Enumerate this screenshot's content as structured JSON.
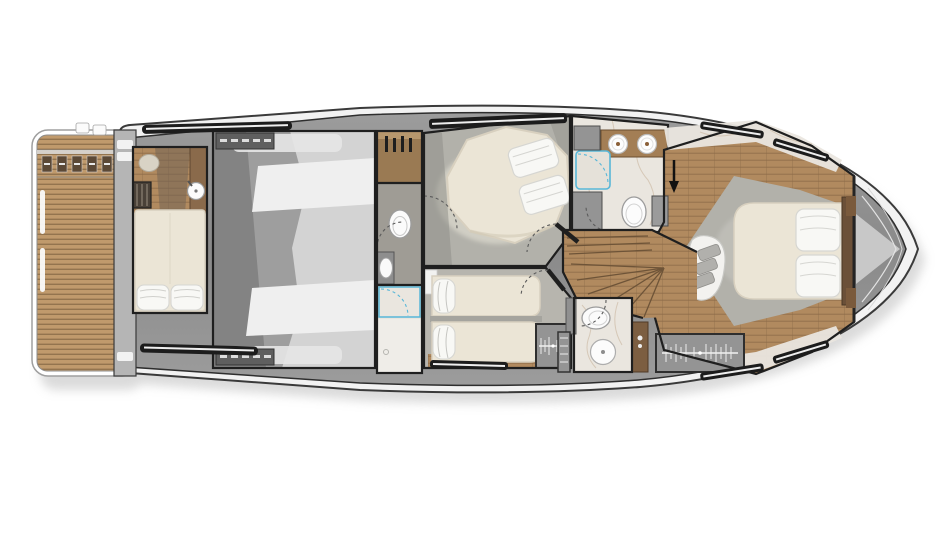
{
  "scene": {
    "type": "yacht-lower-deck-floor-plan",
    "orientation": "bow-right",
    "background": "#ffffff"
  },
  "palette": {
    "hull-rim": "#f2f2f2",
    "hull-line": "#3a3a3a",
    "deck": "#8e8e8e",
    "wall": "#1f1f1f",
    "engine-base": "#9e9e9e",
    "engine-light": "#d3d3d3",
    "engine-bright": "#efefef",
    "engine-shadow": "#838383",
    "teak": "#c09a6c",
    "teak-dark": "#93744e",
    "wood": "#b18a5f",
    "wood-dark": "#8a6a47",
    "cream": "#ebe5d6",
    "cream-edge": "#d8d0bf",
    "pillow": "#f8f8f5",
    "pillow-edge": "#d6d6d2",
    "carpet": "#b2b1aa",
    "carpet-light": "#e9e6d9",
    "marble": "#eae6df",
    "marble-vein": "#c8b49c",
    "cabinet": "#949494",
    "glass-blue": "#58b7d8",
    "window-black": "#1c1c1c",
    "shadow": "#bdbdbd"
  },
  "rooms": [
    {
      "id": "swim-platform",
      "name": "Teak swim platform"
    },
    {
      "id": "crew-cabin",
      "name": "Crew cabin"
    },
    {
      "id": "engine-room",
      "name": "Engine room"
    },
    {
      "id": "utility-corridor",
      "name": "Utility corridor with WC and shower"
    },
    {
      "id": "vip-cabin",
      "name": "VIP guest cabin"
    },
    {
      "id": "twin-cabin",
      "name": "Twin guest cabin"
    },
    {
      "id": "guest-bathroom",
      "name": "Guest bathroom"
    },
    {
      "id": "staircase-foyer",
      "name": "Staircase foyer"
    },
    {
      "id": "day-head",
      "name": "Lower bathroom"
    },
    {
      "id": "master-cabin",
      "name": "Master cabin"
    },
    {
      "id": "bow-locker",
      "name": "Bow locker"
    }
  ],
  "fixtures": {
    "beds": [
      {
        "room": "crew-cabin",
        "type": "single-berth",
        "pillows": 2
      },
      {
        "room": "vip-cabin",
        "type": "double-island-bed",
        "pillows": 2
      },
      {
        "room": "twin-cabin",
        "type": "single-bed",
        "pillows": 1
      },
      {
        "room": "twin-cabin",
        "type": "single-bed",
        "pillows": 1
      },
      {
        "room": "master-cabin",
        "type": "double-island-bed",
        "pillows": 2
      }
    ],
    "toilets": [
      "utility-corridor",
      "guest-bathroom",
      "day-head"
    ],
    "sinks": [
      "crew-cabin",
      "utility-corridor",
      "guest-bathroom",
      "guest-bathroom",
      "day-head"
    ],
    "showers": [
      "utility-corridor",
      "guest-bathroom"
    ],
    "wardrobes": [
      "utility-corridor",
      "twin-cabin",
      "day-head",
      "master-cabin"
    ],
    "sofas": [
      "master-cabin"
    ],
    "staircases": [
      "staircase-foyer"
    ],
    "entry_arrows": [
      "master-cabin"
    ]
  }
}
